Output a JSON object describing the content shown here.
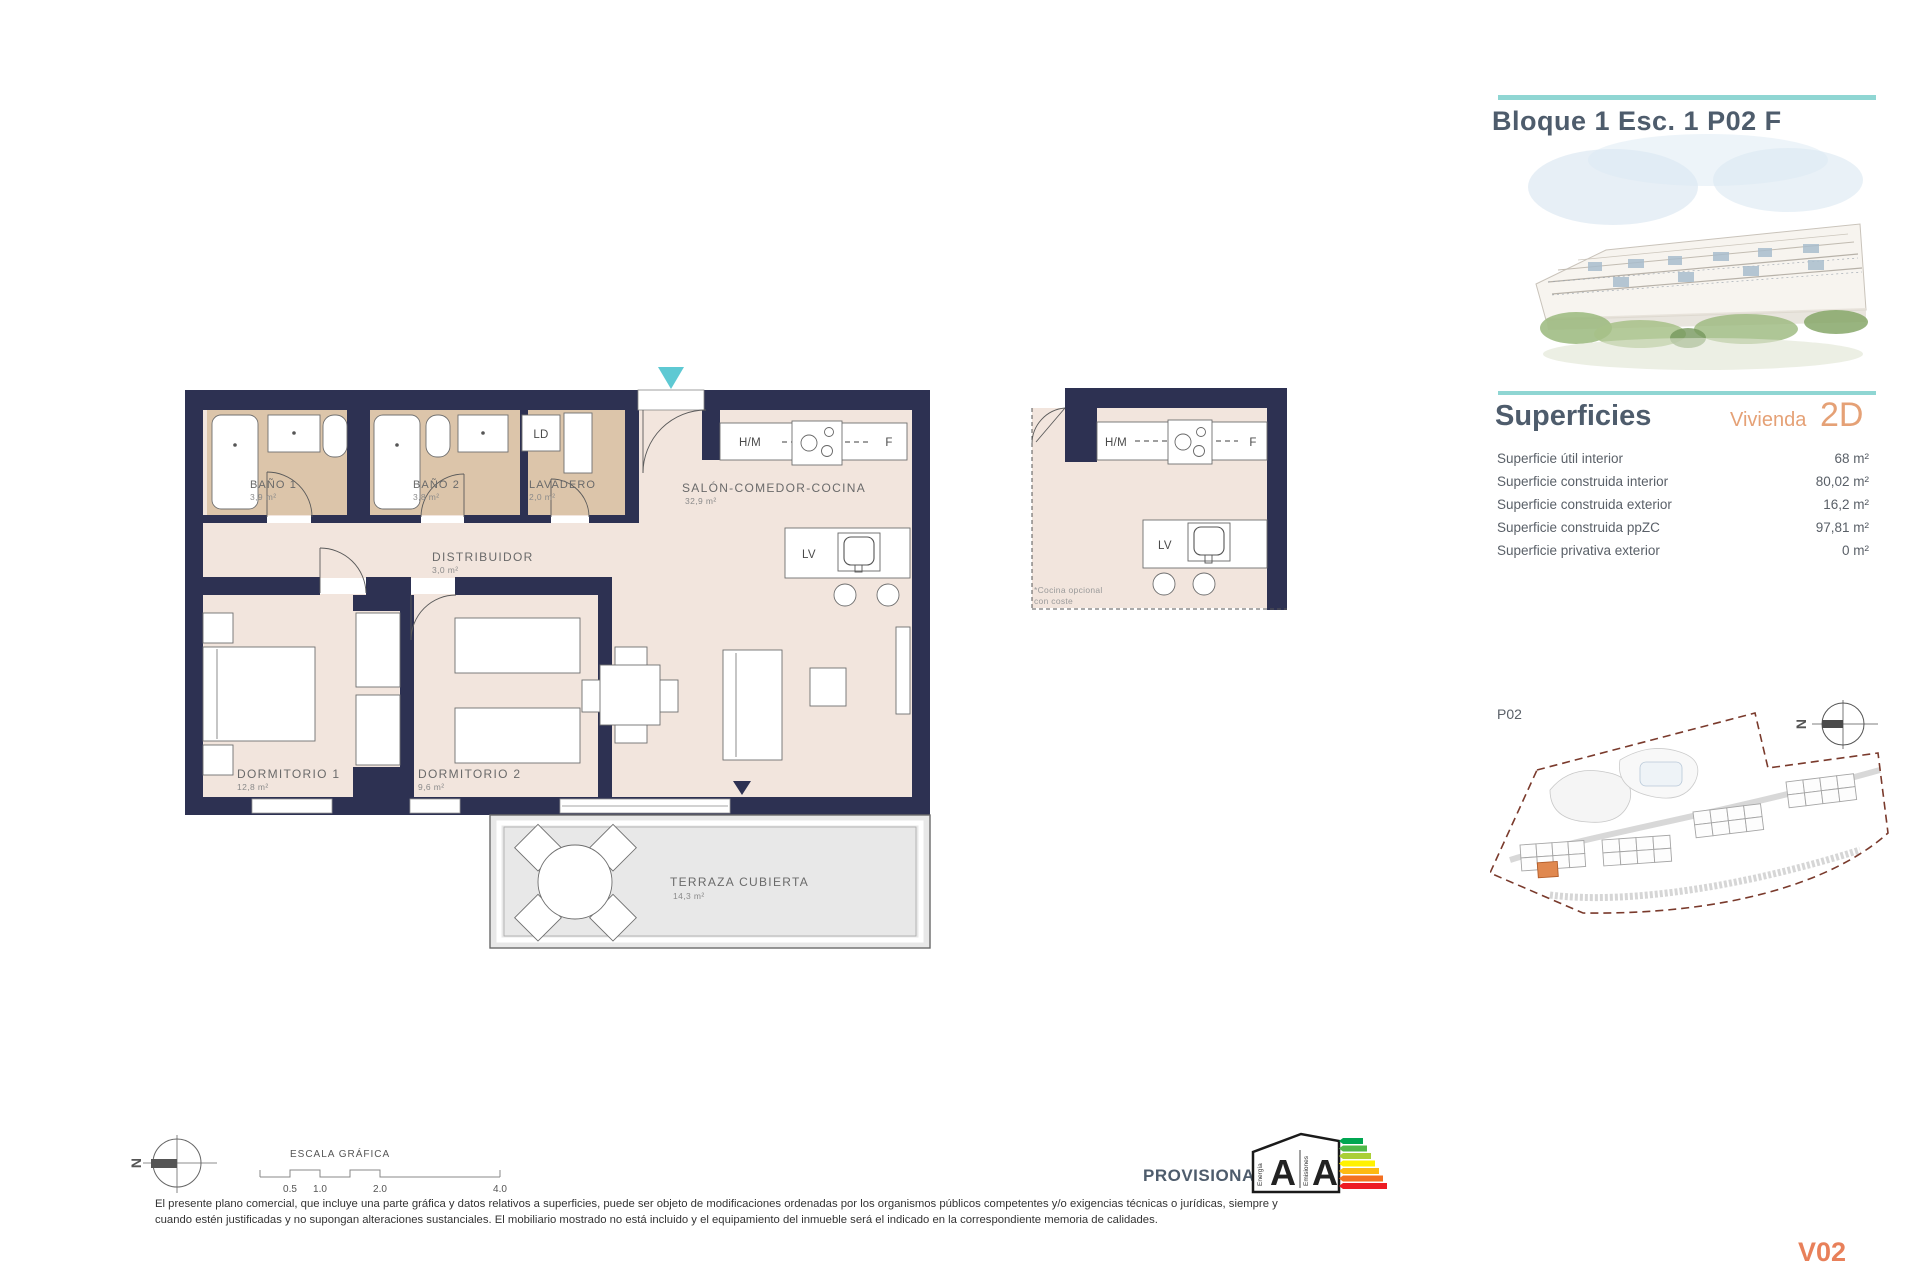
{
  "header": {
    "title": "Bloque 1 Esc. 1 P02 F"
  },
  "superficies": {
    "title": "Superficies",
    "vivienda_label": "Vivienda",
    "type_code": "2D",
    "rows": [
      {
        "label": "Superficie útil interior",
        "value": "68 m²"
      },
      {
        "label": "Superficie construida interior",
        "value": "80,02 m²"
      },
      {
        "label": "Superficie construida exterior",
        "value": "16,2 m²"
      },
      {
        "label": "Superficie construida ppZC",
        "value": "97,81 m²"
      },
      {
        "label": "Superficie privativa exterior",
        "value": "0 m²"
      }
    ]
  },
  "floor_plan": {
    "rooms": {
      "bano1": {
        "name": "BAÑO 1",
        "area": "3,9 m²"
      },
      "bano2": {
        "name": "BAÑO 2",
        "area": "3,8 m²"
      },
      "lavadero": {
        "name": "LAVADERO",
        "area": "2,0 m²"
      },
      "distribuidor": {
        "name": "DISTRIBUIDOR",
        "area": "3,0 m²"
      },
      "salon": {
        "name": "SALÓN-COMEDOR-COCINA",
        "area": "32,9 m²"
      },
      "dormitorio1": {
        "name": "DORMITORIO 1",
        "area": "12,8 m²"
      },
      "dormitorio2": {
        "name": "DORMITORIO 2",
        "area": "9,6 m²"
      },
      "terraza": {
        "name": "TERRAZA CUBIERTA",
        "area": "14,3 m²"
      }
    },
    "appliances": {
      "ld": "LD",
      "hm": "H/M",
      "f": "F",
      "lv": "LV"
    }
  },
  "alt_kitchen": {
    "hm": "H/M",
    "f": "F",
    "lv": "LV",
    "note_line1": "*Cocina opcional",
    "note_line2": "con coste"
  },
  "site_plan": {
    "floor_label": "P02",
    "north_letter": "N"
  },
  "scale_bar": {
    "title": "ESCALA GRÁFICA",
    "ticks": [
      "0.5",
      "1.0",
      "2.0",
      "4.0"
    ]
  },
  "energy_label": {
    "status": "PROVISIONAL",
    "energy_letter": "A",
    "emissions_letter": "A",
    "energy_text": "Energía",
    "emissions_text": "Emisiones"
  },
  "footer": {
    "disclaimer_line1": "El presente plano comercial, que incluye una parte gráfica y datos relativos a superficies, puede ser objeto de modificaciones ordenadas por los organismos públicos competentes y/o exigencias técnicas o jurídicas, siempre y",
    "disclaimer_line2": "cuando estén justificadas y no supongan alteraciones sustanciales. El mobiliario mostrado no está incluido y el equipamiento del inmueble será el indicado en la correspondiente memoria de calidades.",
    "version": "V02"
  },
  "colors": {
    "wall": "#2d3152",
    "teal": "#8fd6d3",
    "accent_orange": "#e5a176",
    "title_slate": "#4e5c6c",
    "tan": "#dcc5aa",
    "floor": "#f2e5dd"
  }
}
